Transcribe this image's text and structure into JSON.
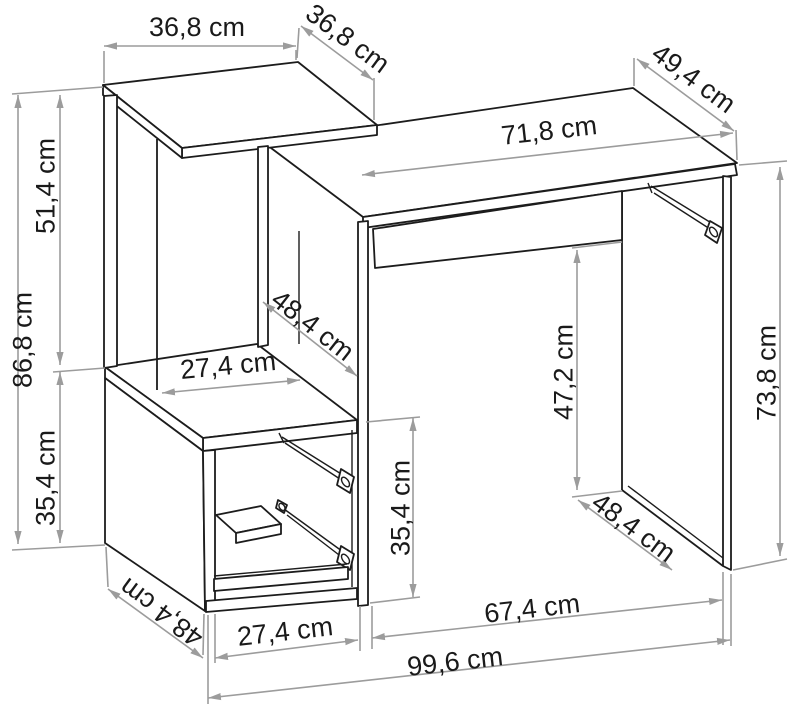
{
  "diagram": {
    "type": "furniture-dimension-diagram",
    "subject": "computer desk with side shelf and drawer cabinet",
    "unit": "cm",
    "colors": {
      "background": "#ffffff",
      "outline": "#1c1c1c",
      "dimension_line": "#9c9c9c",
      "label_text": "#1a1a1a"
    }
  },
  "dimensions": {
    "shelf_top_width": {
      "label": "36,8 cm",
      "value": 36.8
    },
    "shelf_top_depth": {
      "label": "36,8 cm",
      "value": 36.8
    },
    "desk_top_depth": {
      "label": "49,4 cm",
      "value": 49.4
    },
    "desk_top_width": {
      "label": "71,8 cm",
      "value": 71.8
    },
    "shelf_unit_height": {
      "label": "51,4 cm",
      "value": 51.4
    },
    "total_left_height": {
      "label": "86,8 cm",
      "value": 86.8
    },
    "cabinet_height_left": {
      "label": "35,4 cm",
      "value": 35.4
    },
    "shelf_interior_depth": {
      "label": "48,4 cm",
      "value": 48.4
    },
    "shelf_interior_width": {
      "label": "27,4 cm",
      "value": 27.4
    },
    "knee_space_height": {
      "label": "47,2 cm",
      "value": 47.2
    },
    "desk_side_height": {
      "label": "73,8 cm",
      "value": 73.8
    },
    "drawer_space_height": {
      "label": "35,4 cm",
      "value": 35.4
    },
    "cabinet_depth": {
      "label": "48,4 cm",
      "value": 48.4
    },
    "cabinet_interior_width": {
      "label": "27,4 cm",
      "value": 27.4
    },
    "desk_panel_depth": {
      "label": "48,4 cm",
      "value": 48.4
    },
    "knee_space_width": {
      "label": "67,4 cm",
      "value": 67.4
    },
    "total_width": {
      "label": "99,6 cm",
      "value": 99.6
    }
  }
}
